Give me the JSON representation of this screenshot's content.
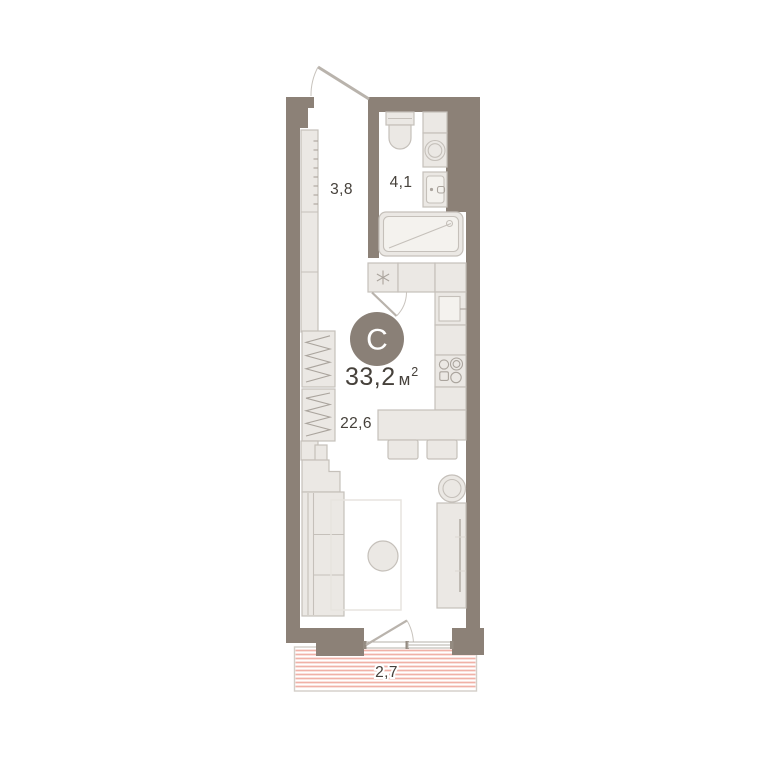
{
  "badge": {
    "letter": "C"
  },
  "total_area": {
    "value": "33,2",
    "unit": "м",
    "superscript": "2"
  },
  "rooms": [
    {
      "id": "hallway",
      "area": "3,8"
    },
    {
      "id": "bathroom",
      "area": "4,1"
    },
    {
      "id": "living-room",
      "area": "22,6"
    },
    {
      "id": "balcony",
      "area": "2,7"
    }
  ],
  "colors": {
    "wall": "#8c8177",
    "furn_fill": "#ebe8e4",
    "furn_stroke": "#c5c0ba",
    "badge_fill": "#8a8077",
    "badge_text": "#ffffff",
    "label_text": "#46413b",
    "balcony_stripe": "#f0b1a7"
  }
}
